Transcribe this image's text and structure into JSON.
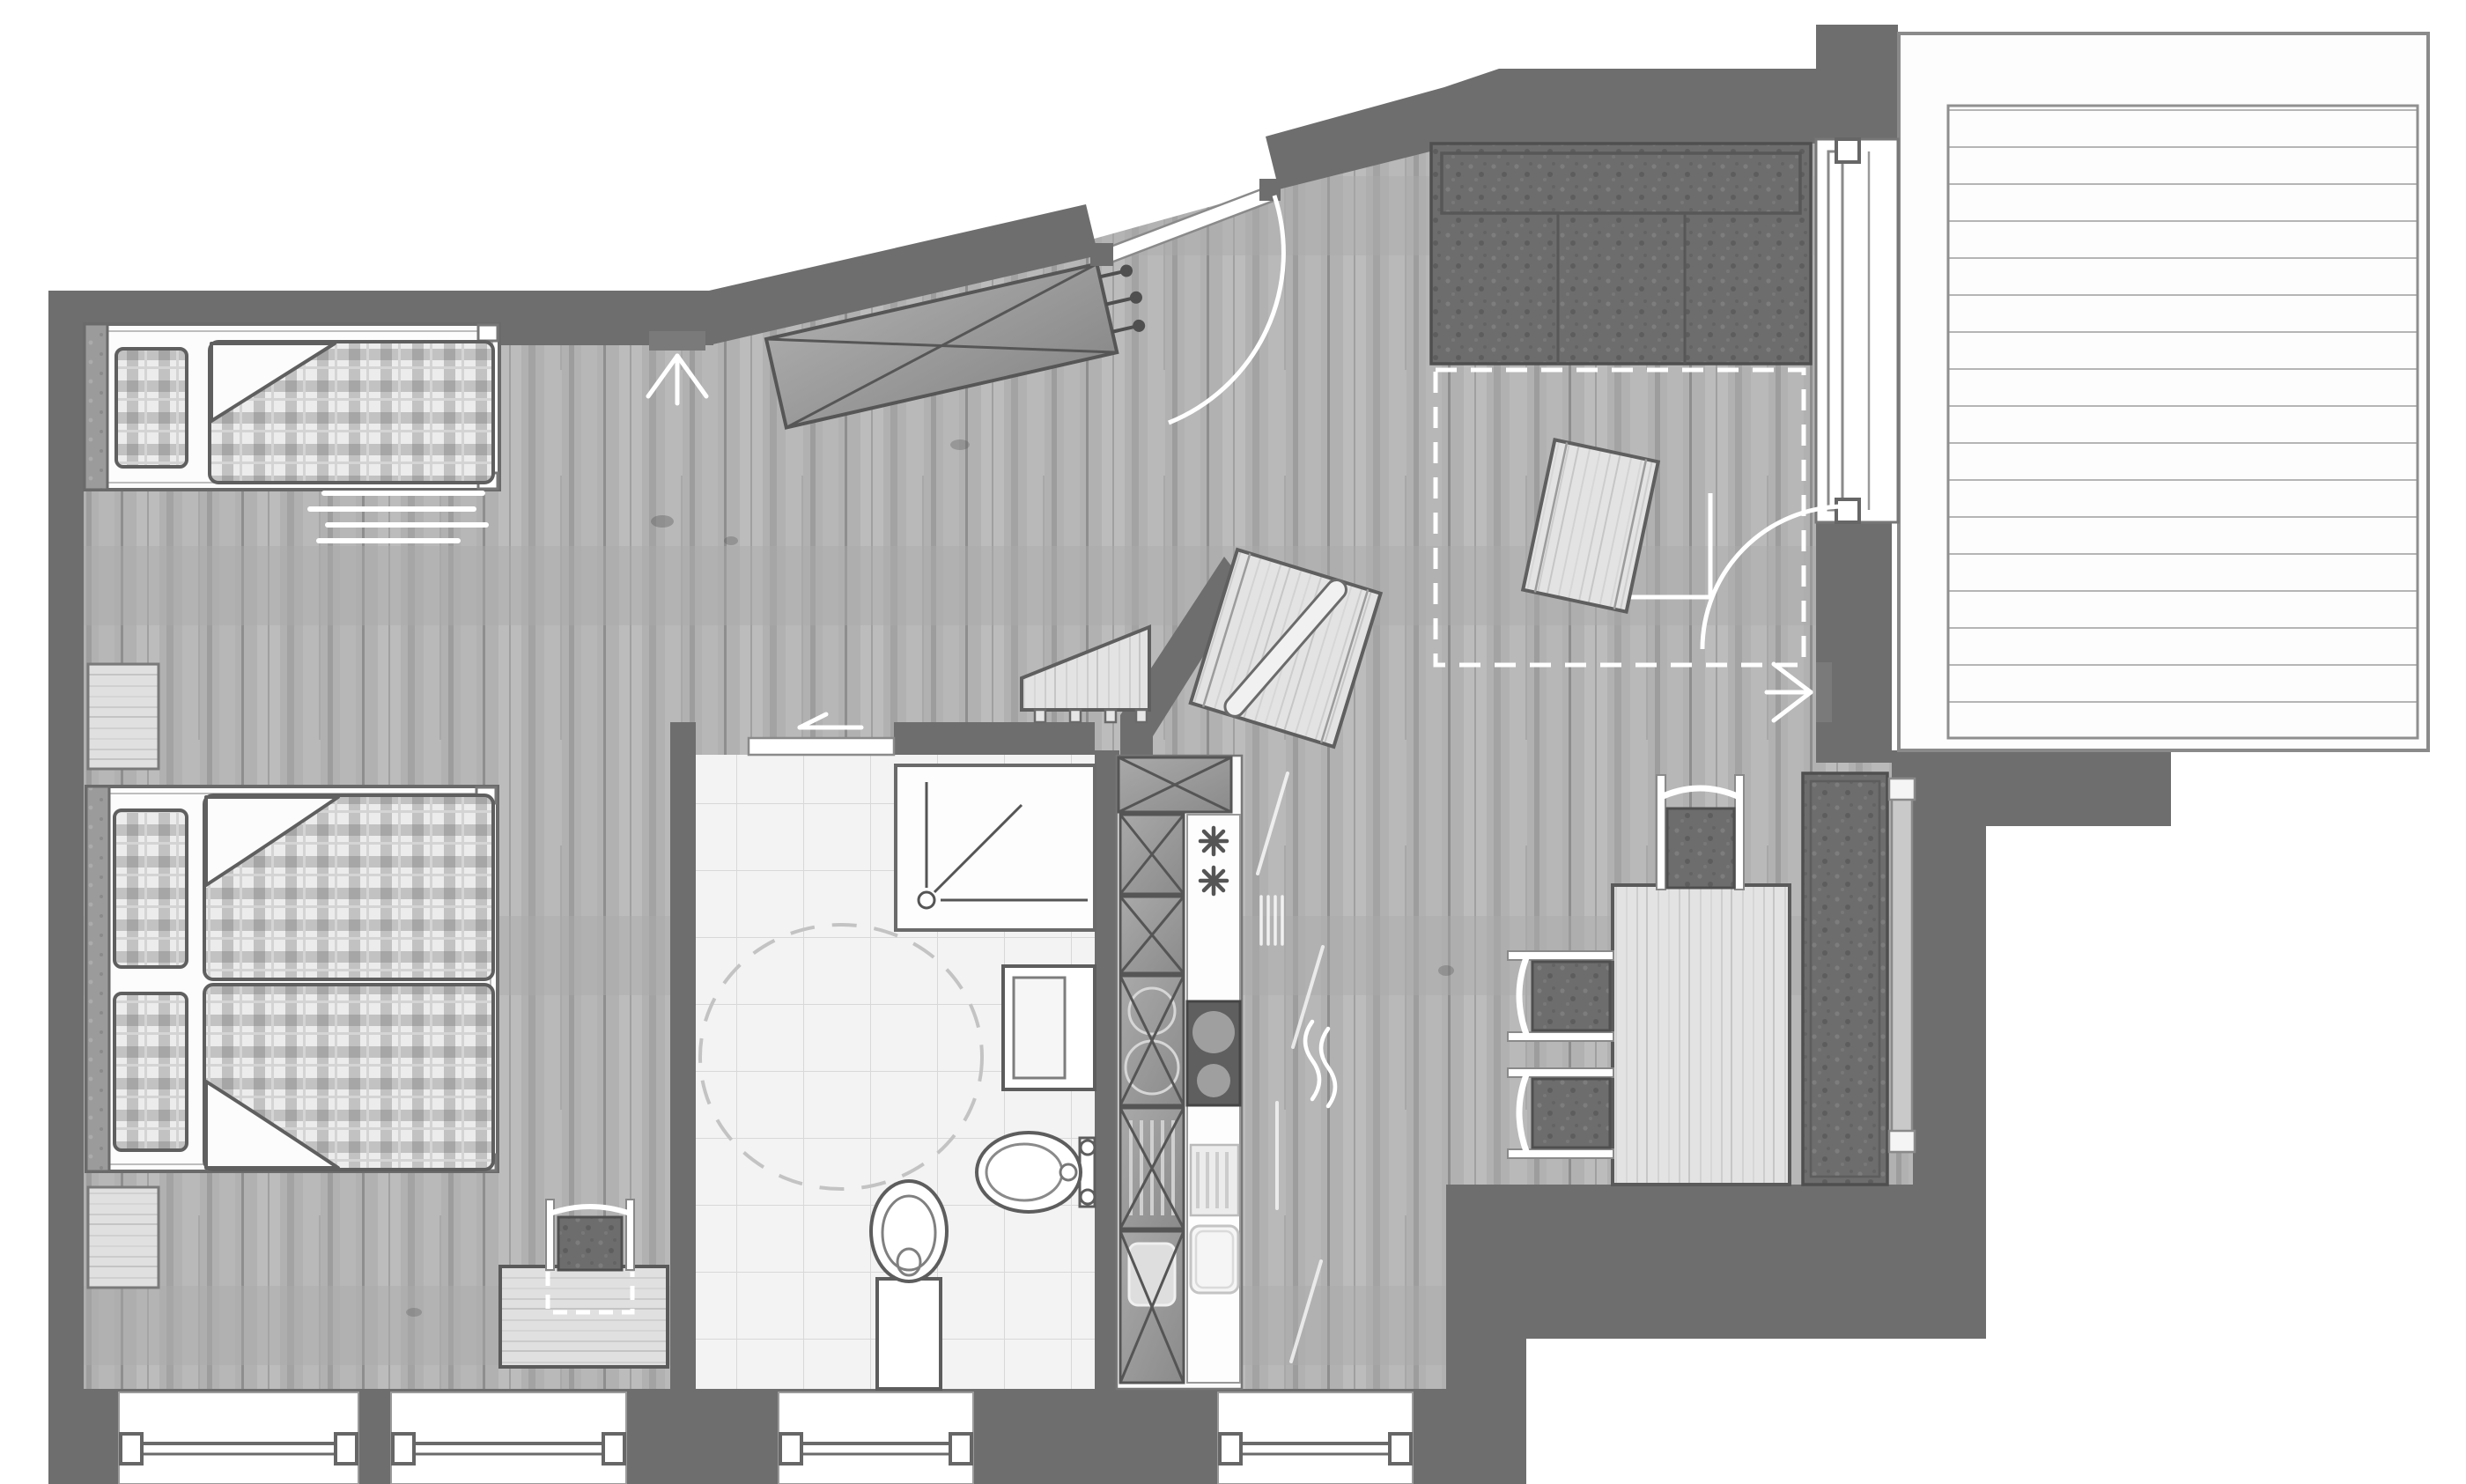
{
  "meta": {
    "type": "architectural-floor-plan",
    "view": "top-down",
    "style": "grayscale rendered plan with wood-texture floor",
    "visible_text": "none"
  },
  "palette": {
    "page_bg": "#ffffff",
    "wall": "#6e6e6e",
    "wall_dark_edge": "#5a5a5a",
    "floor_wood_base": "#b2b2b2",
    "light_wood": "#e2e2e2",
    "white_fixture": "#fcfcfc",
    "plaid_base": "#ececec",
    "plaid_stripe": "#bdbdbd",
    "dark_upholstery": "#6d6d6d",
    "tile_base": "#f3f3f3",
    "tile_line": "#d8d8d8",
    "symbol_white": "#ffffff",
    "outline": "#5a5a5a"
  },
  "rooms": [
    {
      "name": "bedroom",
      "furniture": [
        {
          "item": "single-bed",
          "details": "white frame, upholstered headboard strip at left, plaid pillow, plaid duvet with folded corner"
        },
        {
          "item": "bedside-rug",
          "details": "four white staggered lines below single bed"
        },
        {
          "item": "nightstand-upper",
          "details": "light wood square between beds at wall"
        },
        {
          "item": "double-bed",
          "details": "white frame, two plaid pillows, two plaid duvets with folded corners"
        },
        {
          "item": "nightstand-lower",
          "details": "light wood square below double bed"
        },
        {
          "item": "desk",
          "details": "light wood desk on bottom wall with stool (dark cushion) and dashed pull-out marking"
        },
        {
          "item": "wall-lamp",
          "details": "sconce symbol with three white rays on top wall"
        }
      ]
    },
    {
      "name": "bathroom",
      "fixtures": [
        {
          "item": "shower",
          "details": "square tray top-right with drain circle and corner lines"
        },
        {
          "item": "washbasin",
          "details": "rectangular vanity protruding from right wall"
        },
        {
          "item": "toilet",
          "details": "bottom wall, oval bowl with cistern block"
        },
        {
          "item": "bidet",
          "details": "wall-hung oval with two tap circles, right wall"
        },
        {
          "item": "turning-circle",
          "details": "dashed accessibility circle in room centre"
        },
        {
          "item": "sliding-door",
          "details": "opening at top-left with white slide-direction arrow pointing left"
        }
      ],
      "floor": "light square tiles"
    },
    {
      "name": "kitchenette",
      "fixtures": [
        {
          "item": "tall-cabinet-run",
          "details": "stacked X-marked cabinet boxes, left column"
        },
        {
          "item": "fridge-freezer",
          "details": "two asterisk/snowflake symbols on white counter column"
        },
        {
          "item": "cooktop",
          "details": "dark hob panel with two burner circles plus mirrored circles in cabinet column"
        },
        {
          "item": "dishwasher",
          "details": "ribbed rectangle"
        },
        {
          "item": "sink",
          "details": "rounded rectangle basin at run end"
        },
        {
          "item": "steam-symbol",
          "details": "two wavy white lines on floor beside run"
        }
      ]
    },
    {
      "name": "entry",
      "fixtures": [
        {
          "item": "entrance-door",
          "details": "door in diagonal wall, white leaf shown closed, white quarter-circle swing arc into room, dark jamb blocks"
        },
        {
          "item": "built-in-wardrobe",
          "details": "gray diagonal wardrobe with X cross and three coat hooks on end panel"
        },
        {
          "item": "entry-console",
          "details": "light wood trapezoid bench with four feet against diagonal wall"
        },
        {
          "item": "partition-stub-wall",
          "details": "short diagonal wall between entry and kitchen zone"
        },
        {
          "item": "tilted-side-table",
          "details": "rotated light-wood table with elongated board object on top"
        }
      ]
    },
    {
      "name": "living-dining",
      "furniture": [
        {
          "item": "sofa",
          "details": "dark textured sofa with backrest band along top wall"
        },
        {
          "item": "sofa-bed-extension",
          "details": "white dashed rectangle in front of sofa"
        },
        {
          "item": "coffee-table",
          "details": "small tilted light-wood table"
        },
        {
          "item": "dining-table",
          "details": "light wood rectangular table"
        },
        {
          "item": "dining-chairs",
          "details": "three chairs with dark cushions and white frames (one top, two left)"
        },
        {
          "item": "window-bench",
          "details": "long dark upholstered bench on right wall"
        },
        {
          "item": "radiator",
          "details": "narrow strip with white end caps behind bench"
        },
        {
          "item": "wall-lamp",
          "details": "sconce symbol with three white rays beside balcony door"
        },
        {
          "item": "balcony-door-swing",
          "details": "white quarter arc with L-shaped guide lines"
        }
      ]
    },
    {
      "name": "balcony",
      "details": "large terrace with horizontal decking planks, thin gray border, sliding window/door unit on left wall"
    }
  ],
  "windows": {
    "bottom_wall": [
      {
        "id": "W1",
        "x": "135-407"
      },
      {
        "id": "W2",
        "x": "444-711"
      },
      {
        "id": "W3",
        "x": "884-1105"
      },
      {
        "id": "W4",
        "x": "1383-1604"
      }
    ],
    "right_wall": [
      {
        "id": "balcony-door-unit",
        "y": "158-593"
      }
    ]
  },
  "symbols": {
    "door_swing_arcs": 2,
    "light_rays": 2,
    "dashed_turning_circle": 1,
    "slide_arrow": 1,
    "snowflake_asterisks": 2,
    "steam_wave": 1
  }
}
